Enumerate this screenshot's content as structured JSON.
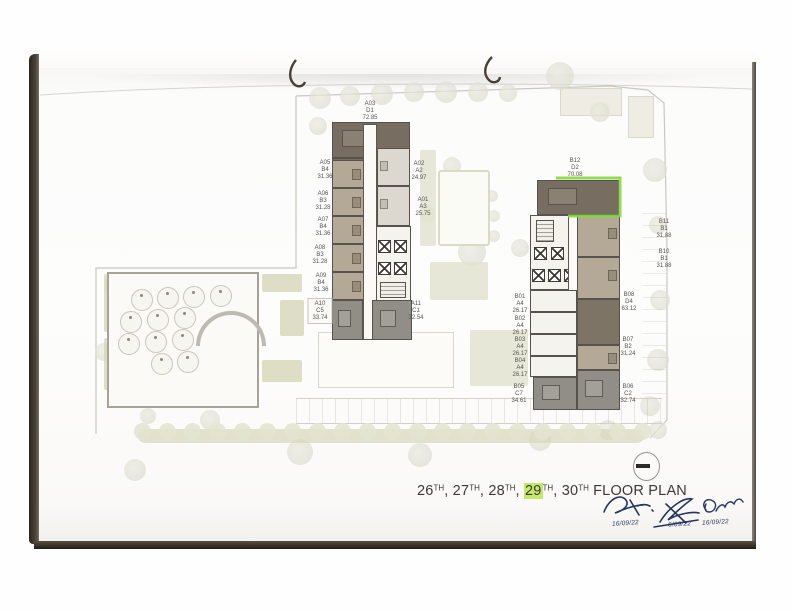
{
  "title": {
    "floors": [
      {
        "num": "26",
        "sup": "TH",
        "highlighted": false
      },
      {
        "num": "27",
        "sup": "TH",
        "highlighted": false
      },
      {
        "num": "28",
        "sup": "TH",
        "highlighted": false
      },
      {
        "num": "29",
        "sup": "TH",
        "highlighted": true
      },
      {
        "num": "30",
        "sup": "TH",
        "highlighted": false
      }
    ],
    "separator": ", ",
    "suffix": "FLOOR PLAN",
    "highlight_color": "#c4e969"
  },
  "signatures": [
    {
      "date": "16/09/22"
    },
    {
      "date": "6/09/22"
    },
    {
      "date": "16/09/22"
    }
  ],
  "buildings": {
    "block_a": {
      "units": [
        {
          "id": "A01",
          "type": "A3",
          "area": "25.75"
        },
        {
          "id": "A02",
          "type": "A2",
          "area": "24.97"
        },
        {
          "id": "A03",
          "type": "D1",
          "area": "72.85"
        },
        {
          "id": "A05",
          "type": "B4",
          "area": "31.36"
        },
        {
          "id": "A06",
          "type": "B3",
          "area": "31.28"
        },
        {
          "id": "A07",
          "type": "B4",
          "area": "31.36"
        },
        {
          "id": "A08",
          "type": "B3",
          "area": "31.28"
        },
        {
          "id": "A09",
          "type": "B4",
          "area": "31.36"
        },
        {
          "id": "A10",
          "type": "C5",
          "area": "33.74"
        },
        {
          "id": "A11",
          "type": "C1",
          "area": "32.54"
        }
      ]
    },
    "block_b": {
      "units": [
        {
          "id": "B01",
          "type": "A4",
          "area": "26.17"
        },
        {
          "id": "B02",
          "type": "A4",
          "area": "26.17"
        },
        {
          "id": "B03",
          "type": "A4",
          "area": "26.17"
        },
        {
          "id": "B04",
          "type": "A4",
          "area": "26.17"
        },
        {
          "id": "B05",
          "type": "C7",
          "area": "34.61"
        },
        {
          "id": "B06",
          "type": "C2",
          "area": "32.74"
        },
        {
          "id": "B07",
          "type": "B2",
          "area": "31.24"
        },
        {
          "id": "B08",
          "type": "D4",
          "area": "63.12"
        },
        {
          "id": "B10",
          "type": "B1",
          "area": "31.88"
        },
        {
          "id": "B11",
          "type": "B1",
          "area": "31.88"
        },
        {
          "id": "B12",
          "type": "D2",
          "area": "70.08"
        }
      ]
    },
    "highlighted_unit": "B12"
  },
  "symbols": {
    "north_marker": "circle-dash-symbol",
    "binder_rings": "binder-hook-icon"
  },
  "colors": {
    "unit_dark": "#776d60",
    "unit_tan": "#b4a997",
    "unit_light": "#dcd8d0",
    "unit_gray": "#918e88",
    "unit_white": "#f5f3ee",
    "highlight_green": "#85d83f",
    "landscape_olive": "#d5d6b6",
    "signature_ink": "#25355e"
  }
}
